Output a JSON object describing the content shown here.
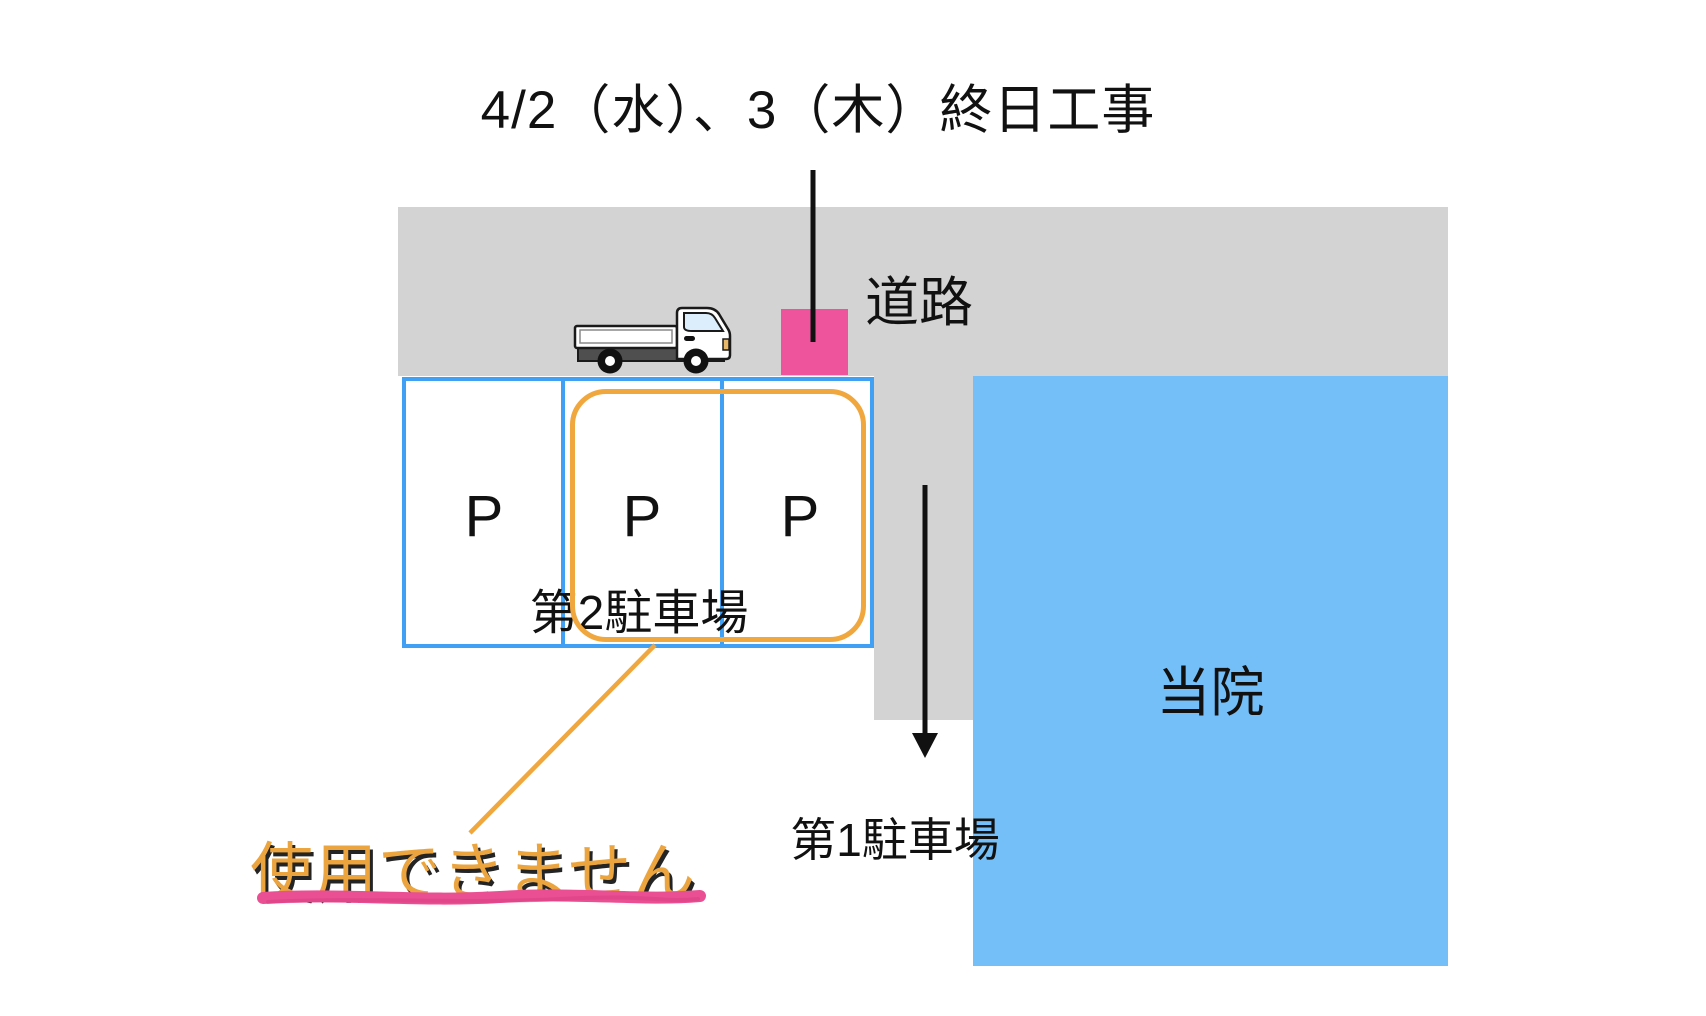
{
  "notice": {
    "title": "4/2（水）、3（木）終日工事",
    "warning": "使用できません"
  },
  "map": {
    "road_label": "道路",
    "lot2": {
      "label": "第2駐車場",
      "spaces": [
        "P",
        "P",
        "P"
      ]
    },
    "lot1_label": "第1駐車場",
    "building_label": "当院"
  },
  "icons": {
    "truck": "truck-icon",
    "construction_marker": "construction-marker",
    "entrance_arrow": "down-arrow-icon"
  },
  "colors": {
    "road_gray": "#d3d3d3",
    "construction_pink": "#ee549c",
    "lot_border_blue": "#3fa0f4",
    "highlight_orange": "#f0a73e",
    "building_blue": "#74bff7",
    "warning_text_orange": "#eba43e",
    "underline_pink": "#ea4f93",
    "text_black": "#111111"
  }
}
